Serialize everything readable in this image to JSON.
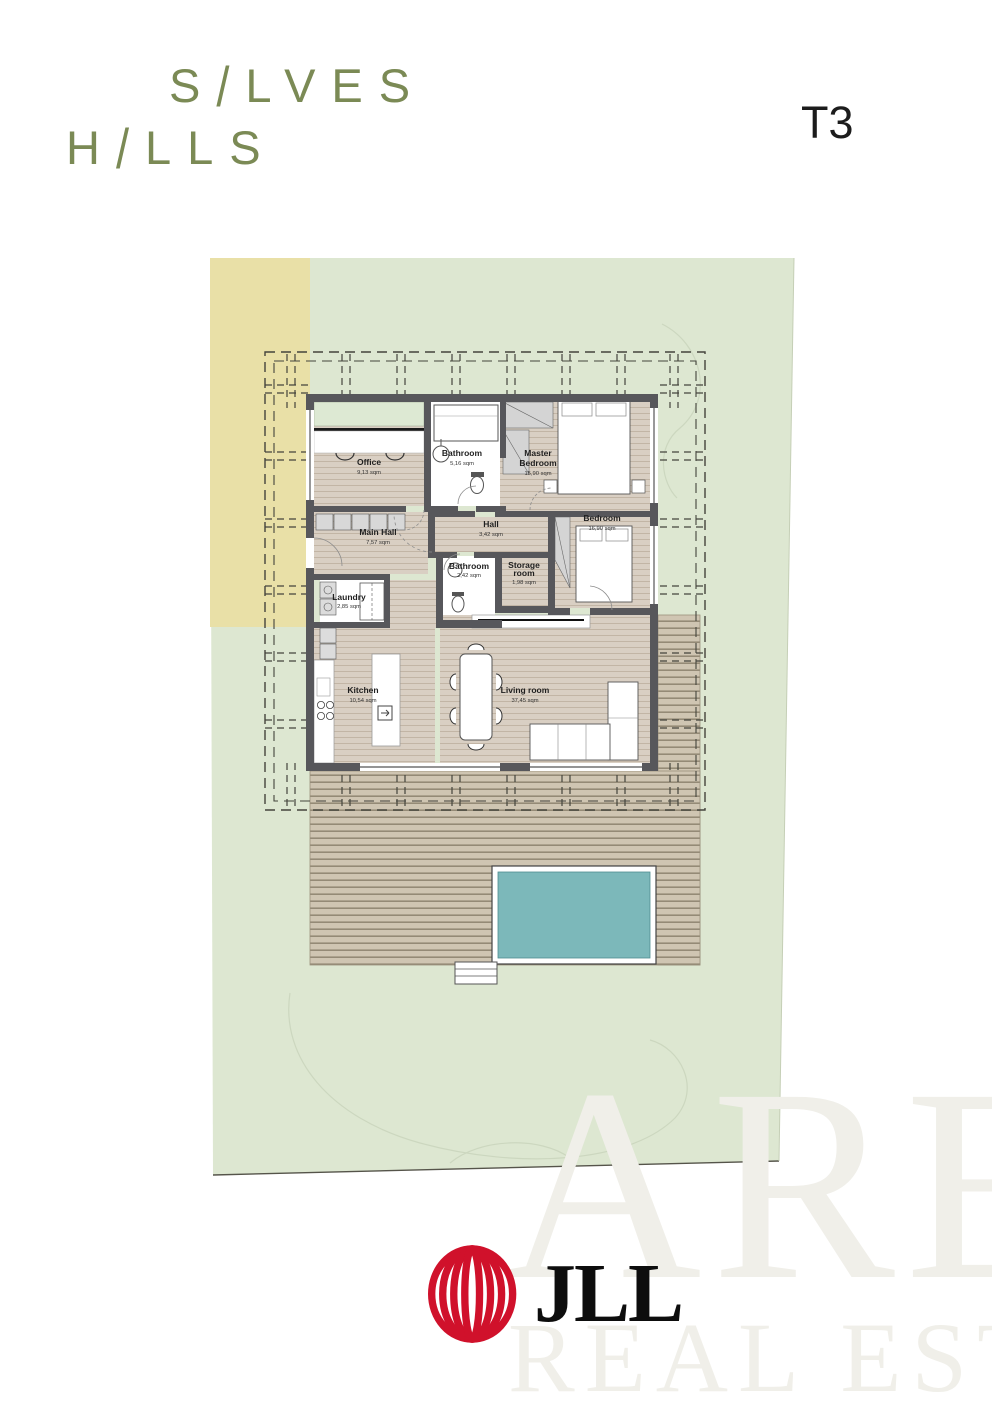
{
  "brand": {
    "line1": {
      "pre": "S",
      "slash": "/",
      "post": "LVES"
    },
    "line2": {
      "pre": "H",
      "slash": "/",
      "post": "LLS"
    }
  },
  "unit_label": "T3",
  "floorplan": {
    "rooms": [
      {
        "id": "office",
        "lines": [
          "Office"
        ],
        "area": "9,13 sqm"
      },
      {
        "id": "bathroom",
        "lines": [
          "Bathroom"
        ],
        "area": "5,16 sqm"
      },
      {
        "id": "master-bedroom",
        "lines": [
          "Master",
          "Bedroom"
        ],
        "area": "15,90 sqm"
      },
      {
        "id": "hall",
        "lines": [
          "Hall"
        ],
        "area": "3,42 sqm"
      },
      {
        "id": "main-hall",
        "lines": [
          "Main Hall"
        ],
        "area": "7,57 sqm"
      },
      {
        "id": "bedroom",
        "lines": [
          "Bedroom"
        ],
        "area": "16,90 sqm"
      },
      {
        "id": "bathroom-2",
        "lines": [
          "Bathroom"
        ],
        "area": "2,42 sqm"
      },
      {
        "id": "storage-room",
        "lines": [
          "Storage",
          "room"
        ],
        "area": "1,98 sqm"
      },
      {
        "id": "laundry",
        "lines": [
          "Laundry"
        ],
        "area": "2,85 sqm"
      },
      {
        "id": "kitchen",
        "lines": [
          "Kitchen"
        ],
        "area": "10,54 sqm"
      },
      {
        "id": "living-room",
        "lines": [
          "Living room"
        ],
        "area": "37,45 sqm"
      }
    ]
  },
  "watermark": {
    "line1": "ARE",
    "line2": "REAL ESTATE"
  },
  "footer": {
    "brand": "JLL"
  },
  "colors": {
    "brand_green": "#7b8a55",
    "site_green": "#dde7d1",
    "sand": "#e9e0a7",
    "pool": "#7cb8ba",
    "wall": "#57575b",
    "jll_red": "#d0112b"
  }
}
